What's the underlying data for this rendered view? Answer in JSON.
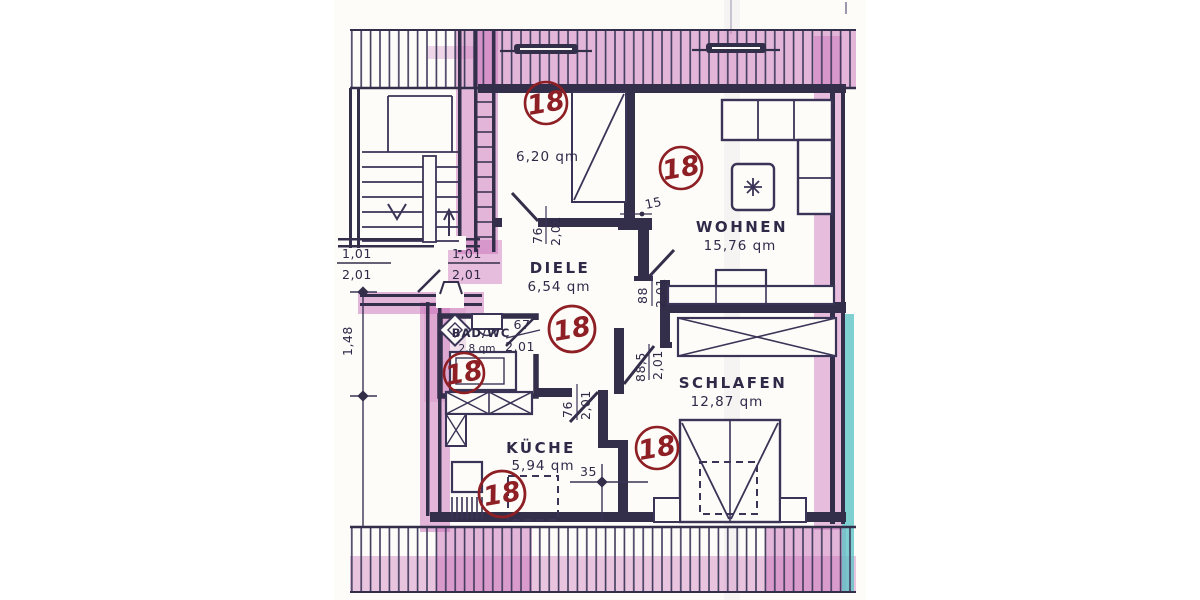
{
  "meta": {
    "tag_number": "18"
  },
  "rooms": {
    "abstellraum": {
      "area": "6,20 qm"
    },
    "wohnen": {
      "name": "WOHNEN",
      "area": "15,76 qm"
    },
    "diele": {
      "name": "DIELE",
      "area": "6,54 qm"
    },
    "bad": {
      "name": "BAD/WC",
      "area": "2,8 qm"
    },
    "schlafen": {
      "name": "SCHLAFEN",
      "area": "12,87 qm"
    },
    "kueche": {
      "name": "KÜCHE",
      "area": "5,94 qm"
    }
  },
  "doors": {
    "abstell": {
      "w": "76",
      "h": "2,01"
    },
    "wohnen": {
      "w": "88",
      "h": "2,01"
    },
    "schlafen": {
      "w": "88,5",
      "h": "2,01"
    },
    "bad": {
      "w": "67",
      "h": "2,01"
    },
    "kueche": {
      "w": "76",
      "h": "2,01"
    }
  },
  "entry": {
    "outer": {
      "w": "1,01",
      "h": "2,01"
    },
    "inner": {
      "w": "1,01",
      "h": "2,01"
    }
  },
  "dimensions": {
    "stair_run": "1,48",
    "wall_thickness": "15",
    "kitchen_offset": "35"
  },
  "colors": {
    "ink": "#332e4a",
    "marker_pink": "#ca70ba",
    "stamp_red": "#8e1f24",
    "edge_teal": "#5fc4c7"
  }
}
